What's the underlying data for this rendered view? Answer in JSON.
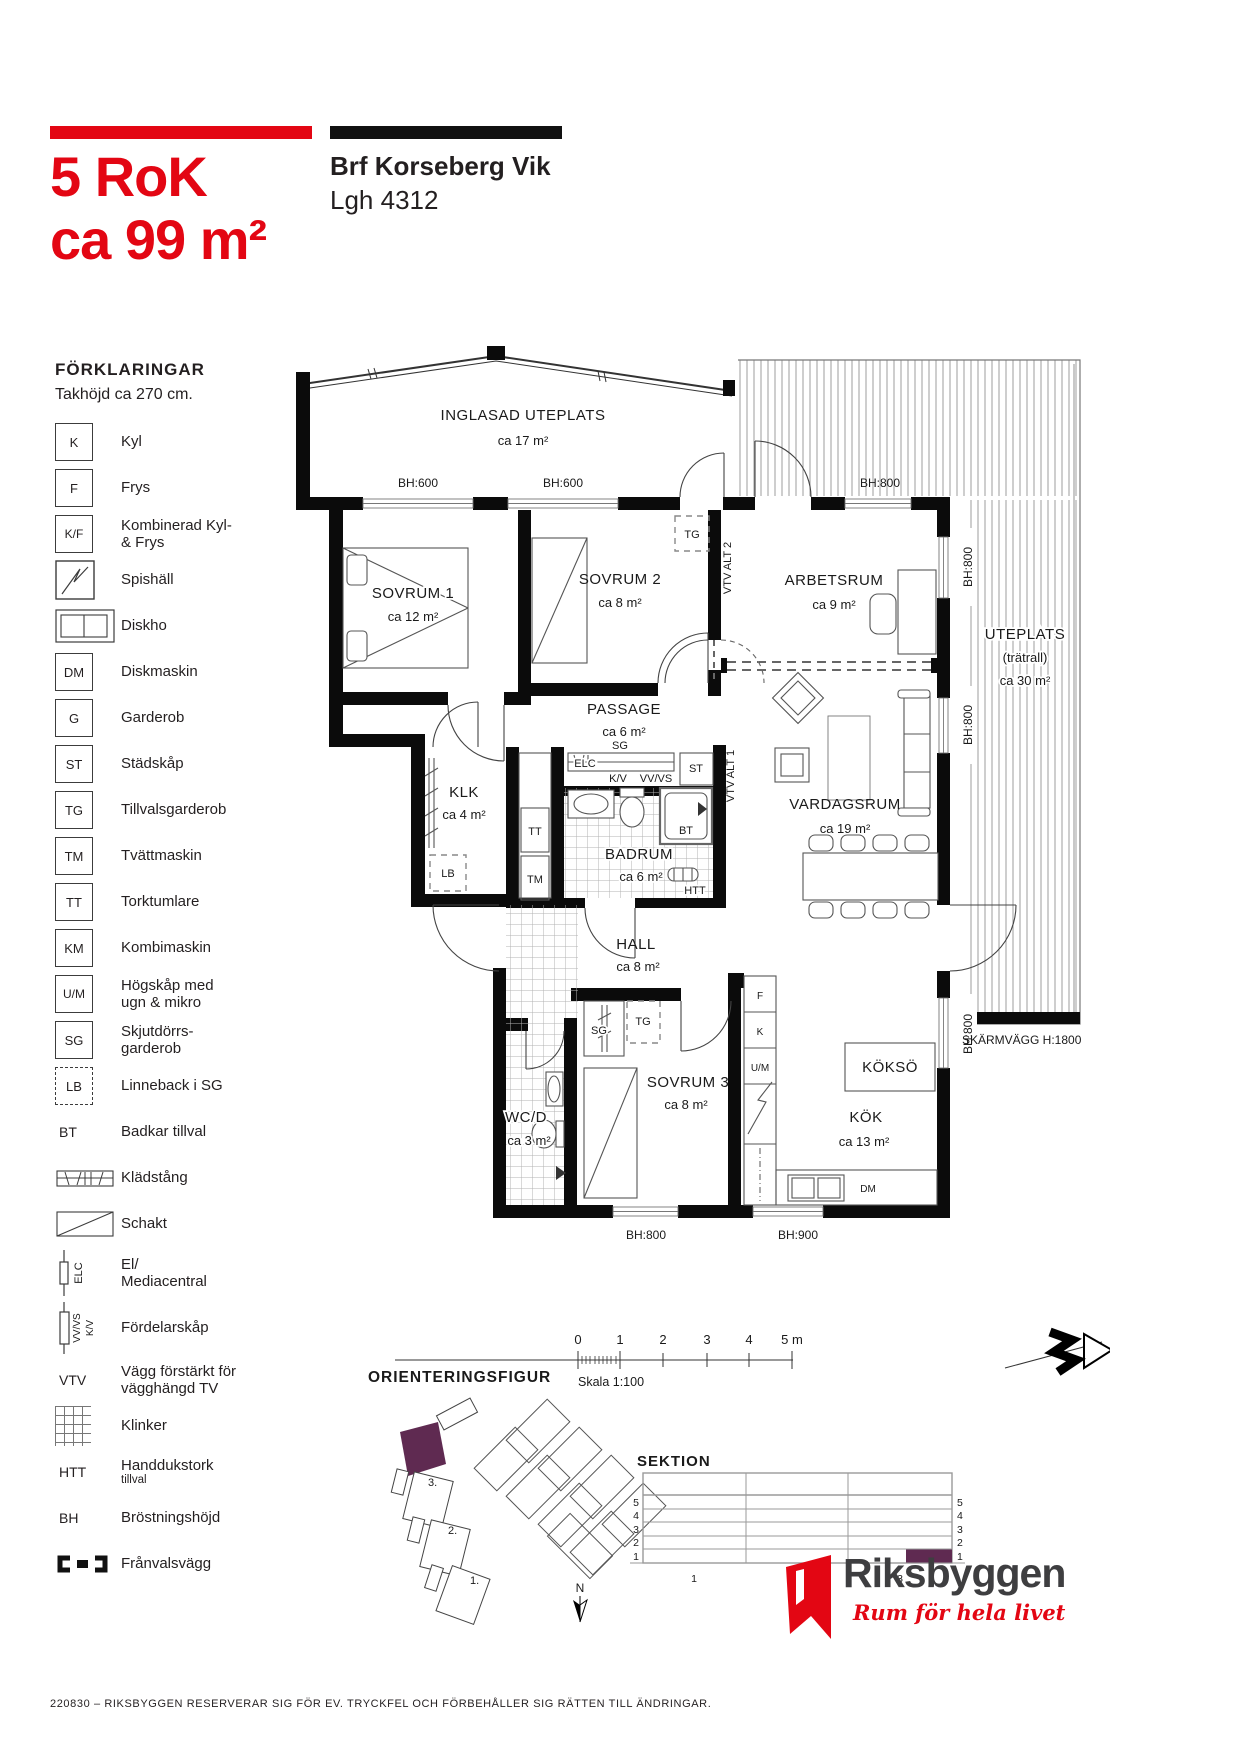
{
  "header": {
    "size": "5 RoK",
    "area": "ca 99 m²",
    "project": "Brf Korseberg Vik",
    "apartment": "Lgh 4312"
  },
  "legend": {
    "title": "FÖRKLARINGAR",
    "subtitle": "Takhöjd ca 270 cm.",
    "items": [
      {
        "symbol": "K",
        "label": "Kyl"
      },
      {
        "symbol": "F",
        "label": "Frys"
      },
      {
        "symbol": "K/F",
        "label": "Kombinerad Kyl-\n& Frys"
      },
      {
        "symbol": "",
        "label": "Spishäll"
      },
      {
        "symbol": "",
        "label": "Diskho"
      },
      {
        "symbol": "DM",
        "label": "Diskmaskin"
      },
      {
        "symbol": "G",
        "label": "Garderob"
      },
      {
        "symbol": "ST",
        "label": "Städskåp"
      },
      {
        "symbol": "TG",
        "label": "Tillvalsgarderob"
      },
      {
        "symbol": "TM",
        "label": "Tvättmaskin"
      },
      {
        "symbol": "TT",
        "label": "Torktumlare"
      },
      {
        "symbol": "KM",
        "label": "Kombimaskin"
      },
      {
        "symbol": "U/M",
        "label": "Högskåp med\nugn & mikro"
      },
      {
        "symbol": "SG",
        "label": "Skjutdörrs-\ngarderob"
      },
      {
        "symbol": "LB",
        "label": "Linneback i SG"
      },
      {
        "symbol": "BT",
        "label": "Badkar tillval"
      },
      {
        "symbol": "",
        "label": "Klädstång"
      },
      {
        "symbol": "",
        "label": "Schakt"
      },
      {
        "symbol": "ELC",
        "label": "El/\nMediacentral"
      },
      {
        "symbol": "",
        "sym1": "VV/VS",
        "sym2": "K/V",
        "label": "Fördelarskåp"
      },
      {
        "symbol": "VTV",
        "label": "Vägg förstärkt för\nvägghängd TV"
      },
      {
        "symbol": "",
        "label": "Klinker"
      },
      {
        "symbol": "HTT",
        "label": "Handdukstork",
        "sub": "tillval"
      },
      {
        "symbol": "BH",
        "label": "Bröstningshöjd"
      },
      {
        "symbol": "",
        "label": "Frånvalsvägg"
      }
    ]
  },
  "plan": {
    "rooms": {
      "inglasad": {
        "name": "INGLASAD UTEPLATS",
        "area": "ca 17 m²"
      },
      "sovrum1": {
        "name": "SOVRUM 1",
        "area": "ca 12 m²"
      },
      "sovrum2": {
        "name": "SOVRUM 2",
        "area": "ca 8 m²"
      },
      "arbetsrum": {
        "name": "ARBETSRUM",
        "area": "ca 9 m²"
      },
      "passage": {
        "name": "PASSAGE",
        "area": "ca 6 m²"
      },
      "klk": {
        "name": "KLK",
        "area": "ca 4 m²"
      },
      "badrum": {
        "name": "BADRUM",
        "area": "ca 6 m²"
      },
      "vardagsrum": {
        "name": "VARDAGSRUM",
        "area": "ca 19 m²"
      },
      "hall": {
        "name": "HALL",
        "area": "ca 8 m²"
      },
      "wcd": {
        "name": "WC/D",
        "area": "ca 3 m²"
      },
      "sovrum3": {
        "name": "SOVRUM 3",
        "area": "ca 8 m²"
      },
      "kok": {
        "name": "KÖK",
        "area": "ca 13 m²"
      },
      "kokso": {
        "name": "KÖKSÖ"
      },
      "uteplats": {
        "name": "UTEPLATS",
        "name2": "(trätrall)",
        "area": "ca 30 m²"
      }
    },
    "marks": {
      "bh600": "BH:600",
      "bh800": "BH:800",
      "bh900": "BH:900",
      "skarmvagg": "SKÄRMVÄGG H:1800",
      "tg": "TG",
      "sg": "SG",
      "st": "ST",
      "elc": "ELC",
      "kv": "K/V",
      "vvvs": "VV/VS",
      "vtv_alt1": "VTV ALT 1",
      "vtv_alt2": "VTV ALT 2",
      "tt": "TT",
      "tm": "TM",
      "lb": "LB",
      "bt": "BT",
      "htt": "HTT",
      "f": "F",
      "k": "K",
      "um": "U/M",
      "dm": "DM"
    }
  },
  "figures": {
    "scalebar": {
      "t0": "0",
      "t1": "1",
      "t2": "2",
      "t3": "3",
      "t4": "4",
      "t5": "5 m",
      "scale": "Skala 1:100"
    },
    "orientering": {
      "title": "ORIENTERINGSFIGUR",
      "b3": "3.",
      "b2": "2.",
      "b1": "1.",
      "north": "N"
    },
    "sektion": {
      "title": "SEKTION",
      "f5": "5",
      "f4": "4",
      "f3": "3",
      "f2": "2",
      "f1": "1",
      "a1": "1",
      "a2": "2",
      "a3": "3"
    }
  },
  "logo": {
    "name": "Riksbyggen",
    "tagline": "Rum för hela livet"
  },
  "footer": {
    "disclaimer": "220830 – RIKSBYGGEN RESERVERAR SIG FÖR EV. TRYCKFEL OCH FÖRBEHÅLLER SIG RÄTTEN TILL ÄNDRINGAR."
  },
  "colors": {
    "red": "#e30613",
    "purple": "#5f2a51",
    "wall": "#0b0b0b"
  }
}
